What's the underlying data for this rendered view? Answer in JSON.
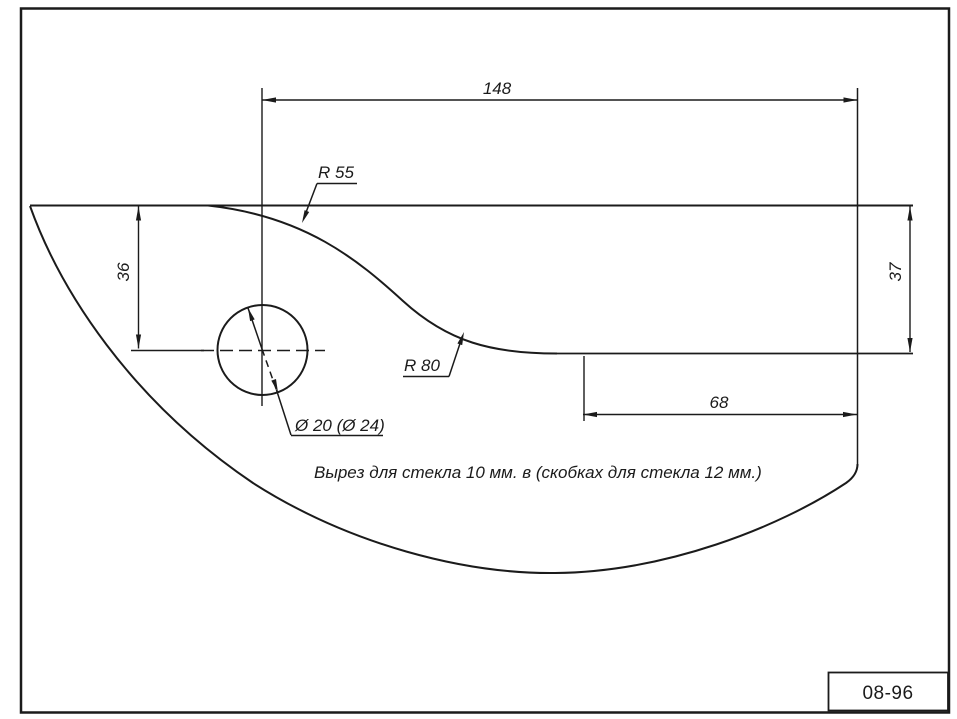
{
  "drawing": {
    "note": "Вырез для стекла 10 мм. в (скобках для стекла 12 мм.)",
    "doc_number": "08-96",
    "dimensions": {
      "top_width": "148",
      "left_height": "36",
      "right_height": "37",
      "bottom_width": "68",
      "radius_top": "R 55",
      "radius_bottom": "R 80",
      "hole_diameter": "Ø 20 (Ø 24)"
    },
    "colors": {
      "line": "#1b1b1b",
      "paper": "#ffffff"
    }
  }
}
